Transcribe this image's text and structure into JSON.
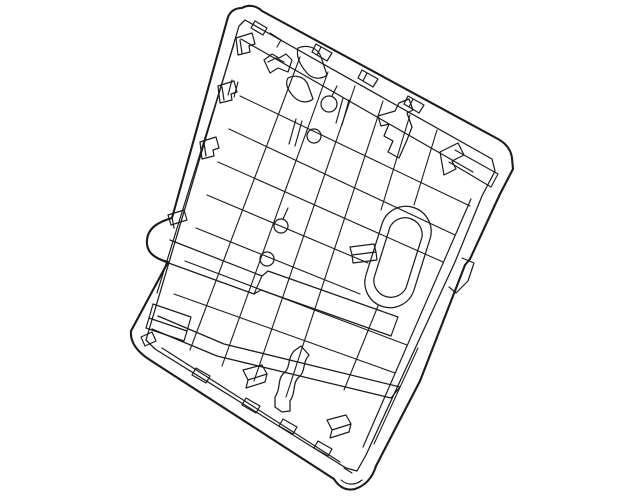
{
  "page": {
    "background": "#ffffff",
    "description": "Black-and-white technical parts diagram of a vehicle seat back frame panel, drawn as thin outline linework, tilted clockwise on a plain white background. No text, labels or UI chrome visible."
  },
  "drawing": {
    "viewbox": "0 0 640 497",
    "width": 640,
    "height": 497,
    "stroke_color": "#1b1b1b",
    "fill": "none",
    "features": [
      "rounded rotated rectangular panel outline with bottom corner foot",
      "double rim border inside all edges",
      "diagonal rib lattice in the center",
      "capsule-shaped boss on the right side",
      "four small pin holes with leader tails",
      "clip tabs along left, top and bottom rims",
      "upper and lower cross beams",
      "s-shaped channel near bottom center"
    ],
    "shapes": [
      {
        "n": "outer-outline",
        "w": 2.1,
        "d": "M 242,8 C 249,4 257,6 262,11 L 498,139 C 507,144 511,150 512,158 L 513,169 L 500,194 L 470,259 L 465,265 L 420,381 L 376,466 C 372,479 364,486 355,489 C 346,491 339,487 334,479 L 150,360 C 136,351 130,341 131,331 L 168,262 C 152,258 146,250 147,240 C 148,228 158,222 172,218 L 228,17 C 231,10 236,8 242,8 Z"
      },
      {
        "n": "inner-rim",
        "w": 1.25,
        "d": "M 245,20 L 492,159 L 495,171 L 482,196 L 455,262 L 366,455 L 357,471 L 346,468 L 155,349 L 146,340 L 239,26 Z"
      },
      {
        "n": "top-deep-rim",
        "w": 1.2,
        "d": "M 241,39 L 473,172"
      },
      {
        "n": "left-deep-rim",
        "w": 1.2,
        "d": "M 234,44 L 157,293"
      },
      {
        "n": "bottom-deep-rim",
        "w": 1.2,
        "d": "M 162,348 L 340,462"
      },
      {
        "n": "right-member-boundary",
        "w": 1.2,
        "d": "M 471,199 L 363,447"
      },
      {
        "n": "right-member-inner",
        "w": 1.1,
        "d": "M 418,348 L 374,444"
      },
      {
        "n": "rib-1",
        "w": 1.1,
        "d": "M 300,57 L 190,350"
      },
      {
        "n": "rib-2",
        "w": 1.1,
        "d": "M 328,72 L 222,366"
      },
      {
        "n": "rib-3",
        "w": 1.1,
        "d": "M 355,86 L 254,381"
      },
      {
        "n": "rib-4",
        "w": 1.1,
        "d": "M 383,101 L 286,397"
      },
      {
        "n": "rib-5",
        "w": 1.1,
        "d": "M 410,115 L 381,210"
      },
      {
        "n": "rib-6",
        "w": 1.1,
        "d": "M 437,130 L 414,205"
      },
      {
        "n": "cross-rib-1",
        "w": 1.1,
        "d": "M 240,96 L 470,206"
      },
      {
        "n": "cross-rib-2",
        "w": 1.1,
        "d": "M 229,129 L 455,235"
      },
      {
        "n": "cross-rib-3",
        "w": 1.1,
        "d": "M 218,162 L 443,262"
      },
      {
        "n": "cross-rib-4",
        "w": 1.1,
        "d": "M 207,195 L 368,263"
      },
      {
        "n": "cross-rib-5",
        "w": 1.1,
        "d": "M 196,228 L 360,294"
      },
      {
        "n": "cross-rib-6",
        "w": 1.1,
        "d": "M 185,261 L 407,345"
      },
      {
        "n": "cross-rib-7",
        "w": 1.1,
        "d": "M 174,294 L 395,373"
      },
      {
        "n": "beam-upper-top",
        "w": 1.25,
        "d": "M 170,240 L 262,276 L 268,271 L 398,317"
      },
      {
        "n": "beam-upper-bottom",
        "w": 1.25,
        "d": "M 163,261 L 254,294 L 261,290 L 391,336"
      },
      {
        "n": "beam-upper-joint",
        "w": 1.1,
        "d": "M 262,276 L 254,294"
      },
      {
        "n": "beam-upper-end",
        "w": 1.1,
        "d": "M 398,317 L 391,336"
      },
      {
        "n": "beam-lower-top",
        "w": 1.25,
        "d": "M 158,316 L 224,344 L 400,387"
      },
      {
        "n": "beam-lower-bottom",
        "w": 1.25,
        "d": "M 152,329 L 217,356 L 391,398"
      },
      {
        "n": "beam-lower-end",
        "w": 1.1,
        "d": "M 400,387 L 391,398"
      },
      {
        "n": "s-channel-left-wall",
        "w": 1.25,
        "d": "M 294,351 C 287,359 291,367 284,373 C 277,379 281,389 275,397 L 275,407"
      },
      {
        "n": "s-channel-right-wall",
        "w": 1.25,
        "d": "M 309,355 C 302,363 306,371 299,377 C 292,383 296,393 290,401 L 290,411"
      },
      {
        "n": "s-channel-top",
        "w": 1.25,
        "d": "M 294,351 L 301,346 L 309,355"
      },
      {
        "n": "s-channel-bottom",
        "w": 1.25,
        "d": "M 275,407 L 282,412 L 290,411"
      },
      {
        "n": "capsule-boss-outer",
        "w": 1.25,
        "d": "M 430,239 L 414,290 A 25,25 0 0 1 366,275 L 382,224 A 25,25 0 0 1 430,239 Z"
      },
      {
        "n": "capsule-boss-inner",
        "w": 1.25,
        "d": "M 422,237 L 406,288 A 17,17 0 0 1 374,278 L 390,227 A 17,17 0 0 1 422,237 Z"
      },
      {
        "n": "clip-left-1",
        "w": 1.2,
        "d": "M 236,38 L 252,33 L 255,44 L 249,46 L 250,52 L 238,55 Z M 240,40 L 242,53"
      },
      {
        "n": "clip-left-2",
        "w": 1.2,
        "d": "M 218,86 L 234,81 L 237,92 L 231,94 L 232,100 L 220,103 Z M 222,87 L 224,100"
      },
      {
        "n": "clip-left-3",
        "w": 1.2,
        "d": "M 200,142 L 216,137 L 219,148 L 213,150 L 214,156 L 202,159 Z M 204,143 L 206,156"
      },
      {
        "n": "clip-left-bump",
        "w": 1.2,
        "d": "M 168,215 L 184,210 L 187,220 L 171,225 Z M 172,217 L 174,228"
      },
      {
        "n": "clip-bottom-corner",
        "w": 1.2,
        "d": "M 141,337 L 152,332 L 156,341 L 145,346 Z"
      },
      {
        "n": "corner-tab",
        "w": 1.2,
        "d": "M 255,21 L 267,28 L 263,35 L 251,28 Z"
      },
      {
        "n": "rim-step",
        "w": 1.1,
        "d": "M 270,33 L 281,40 L 277,47"
      },
      {
        "n": "tab-top-1",
        "w": 1.2,
        "d": "M 316,44 L 332,53 L 327,61 L 312,52 Z M 321,47 L 317,55"
      },
      {
        "n": "tab-top-2",
        "w": 1.2,
        "d": "M 362,70 L 378,79 L 373,87 L 358,78 Z M 367,73 L 363,81"
      },
      {
        "n": "tab-top-3",
        "w": 1.2,
        "d": "M 408,96 L 424,105 L 419,113 L 404,104 Z M 413,99 L 409,107"
      },
      {
        "n": "hook-upper",
        "w": 1.2,
        "d": "M 298,48 C 308,44 318,48 321,57 L 327,75 C 321,80 312,79 307,73 C 300,65 296,56 298,48 Z"
      },
      {
        "n": "hook-lower",
        "w": 1.2,
        "d": "M 288,78 C 296,74 305,77 308,85 L 313,99 C 307,104 298,102 293,96 C 287,89 285,83 288,78 Z"
      },
      {
        "n": "m-clip",
        "w": 1.2,
        "d": "M 264,60 L 272,54 L 279,58 L 286,54 L 292,60 L 288,72 L 278,68 L 270,73 Z M 268,62 L 276,58 L 284,62"
      },
      {
        "n": "bracket-center",
        "w": 1.25,
        "d": "M 399,103 L 409,99 L 413,110 L 407,113 L 412,127 L 407,140 L 399,158 L 388,152 L 393,141 L 384,136 L 389,124 L 381,126 L 378,116 L 395,111 Z"
      },
      {
        "n": "bracket-right",
        "w": 1.2,
        "d": "M 440,152 L 458,143 L 464,155 L 452,161 L 456,169 L 444,175 Z"
      },
      {
        "n": "corner-pocket-lines",
        "w": 1.1,
        "d": "M 455,150 L 498,174 M 449,162 L 491,187 M 498,174 L 491,187"
      },
      {
        "n": "right-edge-step",
        "w": 1.2,
        "d": "M 462,258 L 474,263 L 468,281 L 456,293 L 449,287"
      },
      {
        "n": "vent-slot-pair-1",
        "w": 1.15,
        "d": "M 296,119 L 289,144 M 302,121 L 295,146"
      },
      {
        "n": "vent-slot-pair-2",
        "w": 1.15,
        "d": "M 343,98 L 336,123 M 349,100 L 342,125"
      },
      {
        "n": "vent-slot-pair-3",
        "w": 1.15,
        "d": "M 232,80 L 228,95 M 238,82 L 234,97"
      },
      {
        "n": "tab-capsule-left",
        "w": 1.2,
        "d": "M 350,247 L 374,244 L 376,252 L 352,255 Z M 352,255 L 353,263 L 377,260 L 376,252"
      },
      {
        "n": "wedge-clip-1",
        "w": 1.2,
        "d": "M 243,370 L 262,365 L 267,374 L 248,380 Z M 248,380 L 246,388 L 265,382 L 267,374"
      },
      {
        "n": "wedge-clip-2",
        "w": 1.2,
        "d": "M 327,420 L 346,415 L 351,424 L 332,430 Z M 332,430 L 330,438 L 349,432 L 351,424"
      },
      {
        "n": "bottom-rim-tabs",
        "w": 1.2,
        "d": "M 196,368 L 210,376 L 206,383 L 192,375 Z M 246,398 L 260,406 L 256,413 L 242,405 Z M 283,419 L 297,427 L 293,434 L 279,426 Z M 318,441 L 332,449 L 328,456 L 314,448 Z"
      },
      {
        "n": "box-lower-left",
        "w": 1.2,
        "d": "M 153,304 L 191,317 L 187,331 L 149,318 Z M 187,331 L 184,341 L 146,328 L 149,318"
      },
      {
        "n": "capsule-bottom-link",
        "w": 1.1,
        "d": "M 378,306 L 344,390"
      },
      {
        "n": "pin-tails",
        "w": 1.15,
        "d": "M 332,96 L 337,86 M 283,219 L 288,208"
      },
      {
        "n": "foot-inner",
        "w": 1.15,
        "d": "M 341,480 C 348,486 356,485 362,480 M 344,468 L 352,473"
      }
    ],
    "circles": [
      {
        "n": "pin-hole-1",
        "cx": 329,
        "cy": 104,
        "r": 8,
        "w": 1.25
      },
      {
        "n": "pin-hole-2",
        "cx": 314,
        "cy": 136,
        "r": 7,
        "w": 1.25
      },
      {
        "n": "pin-hole-3",
        "cx": 281,
        "cy": 226,
        "r": 7,
        "w": 1.25
      },
      {
        "n": "pin-hole-4",
        "cx": 267,
        "cy": 259,
        "r": 7,
        "w": 1.25
      }
    ]
  }
}
